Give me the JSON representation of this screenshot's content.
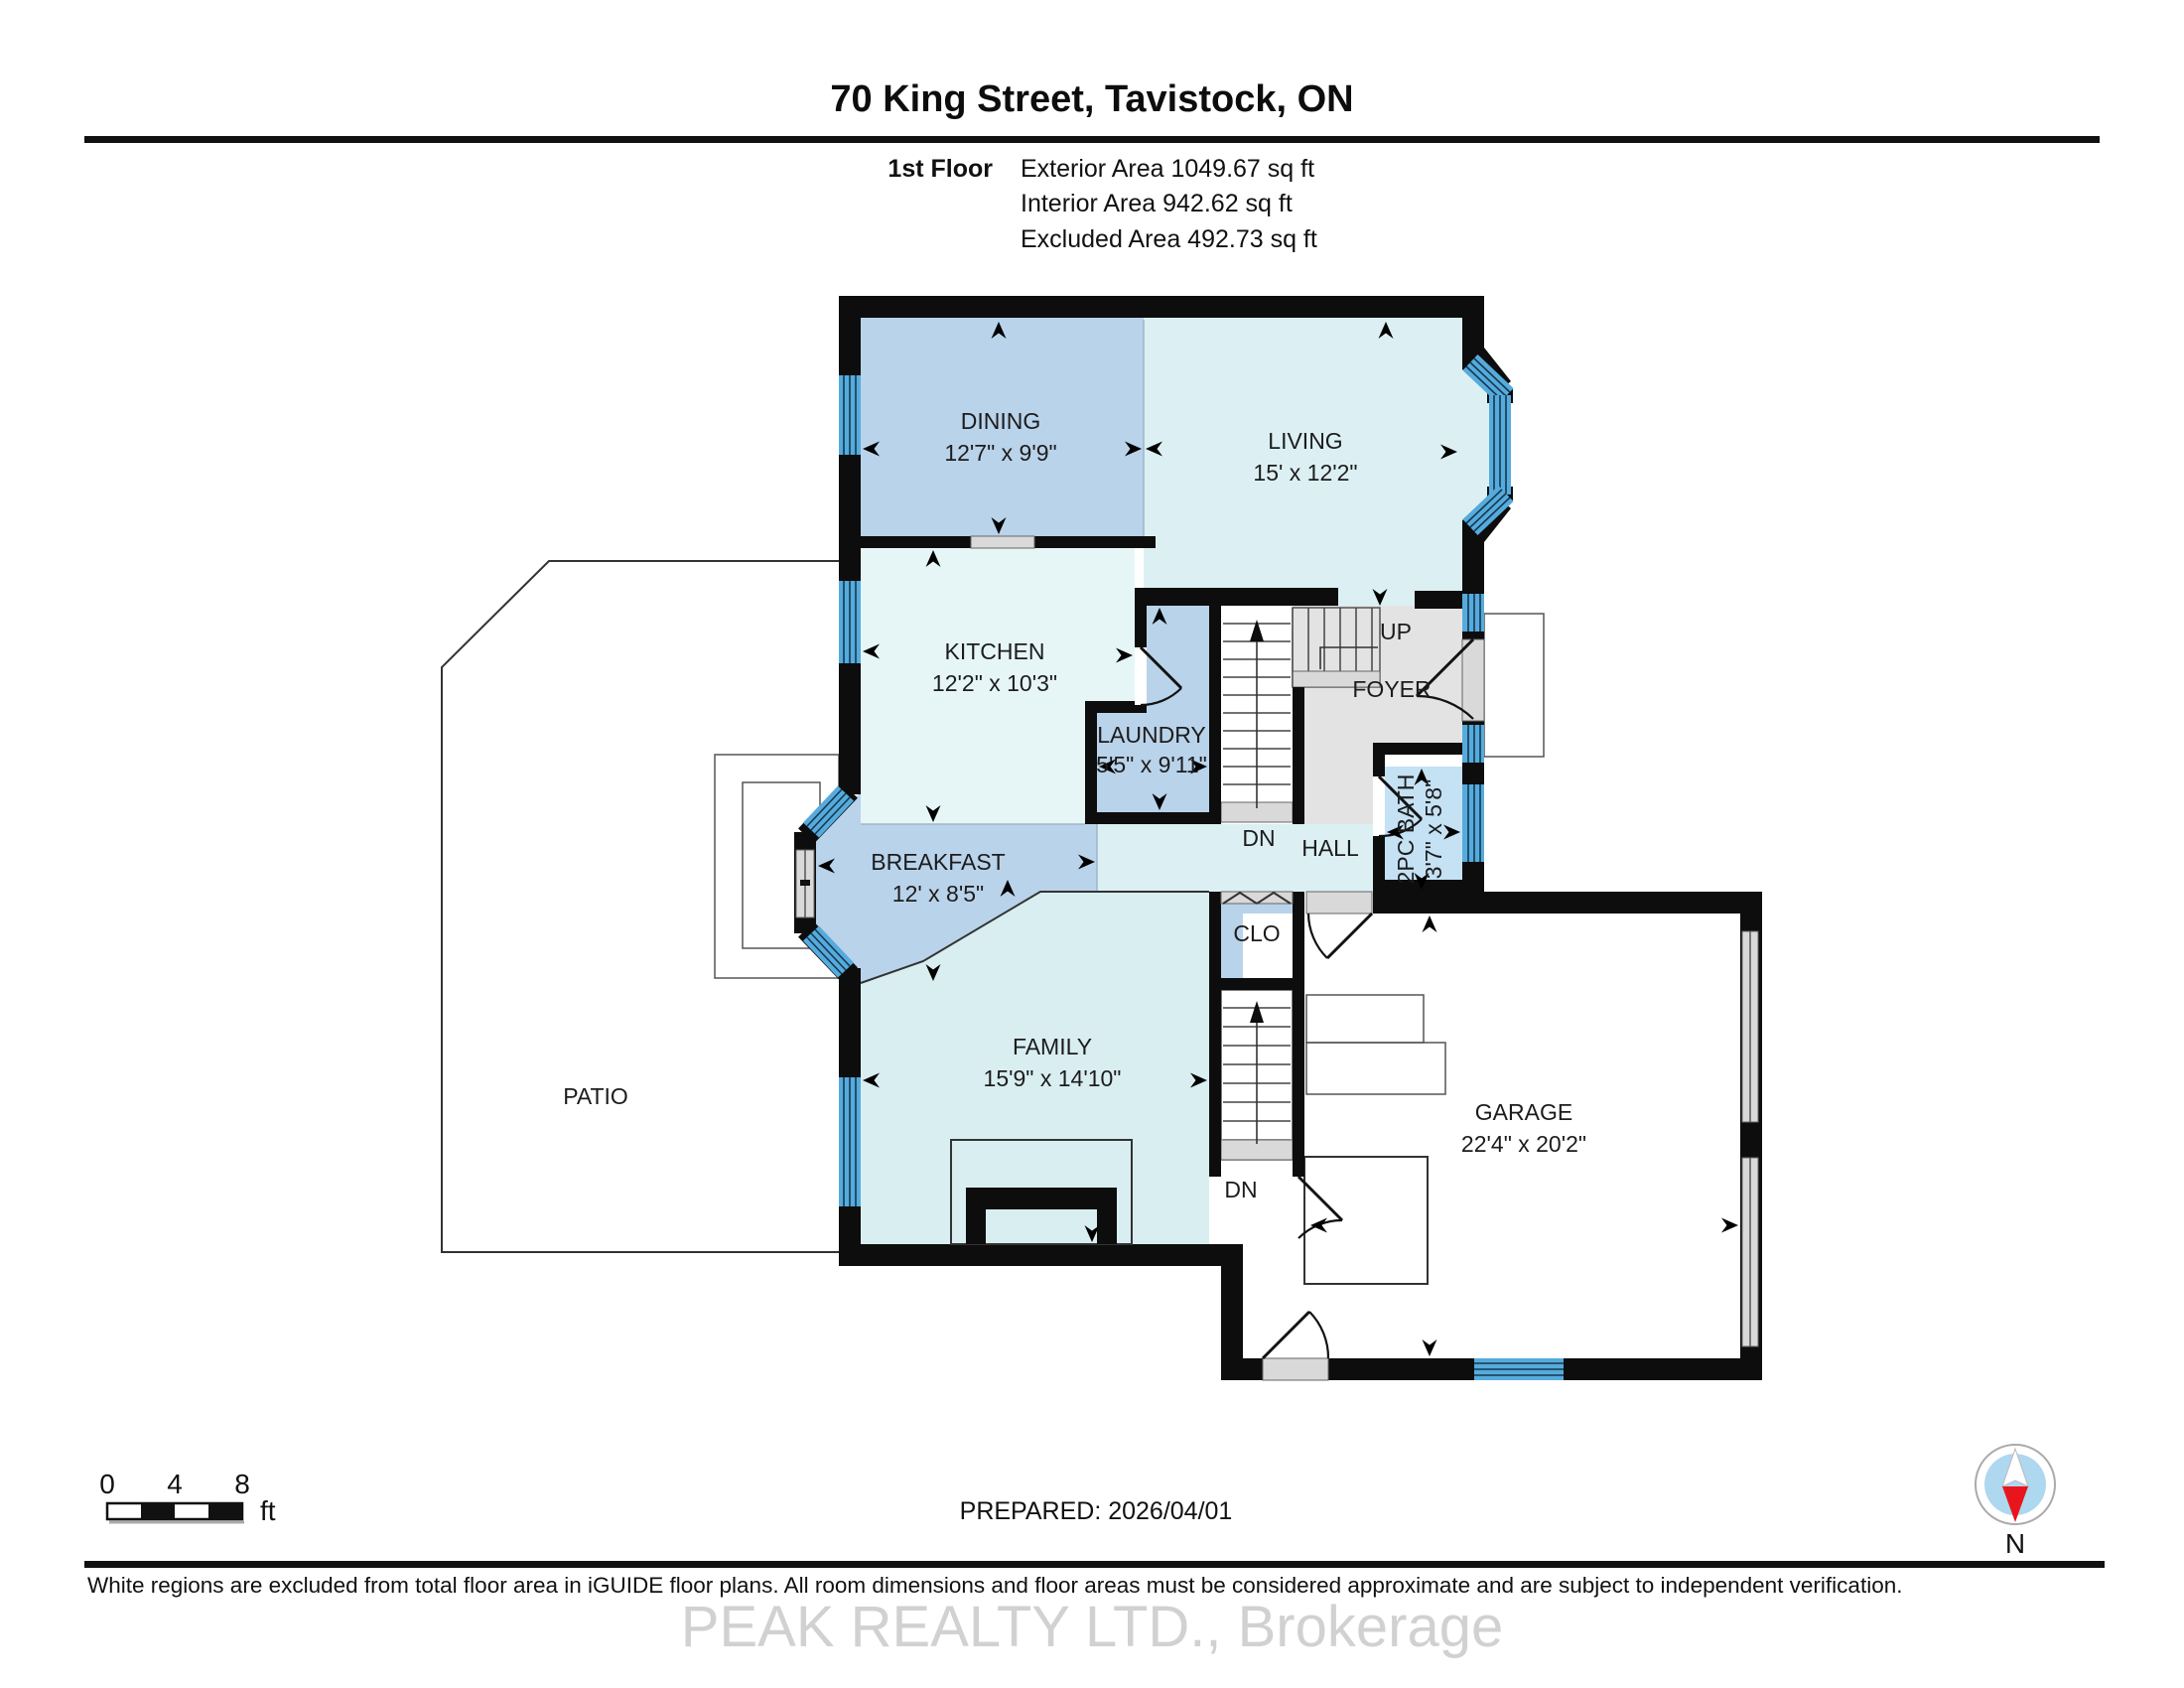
{
  "page_title": "70 King Street, Tavistock, ON",
  "header": {
    "floor_label": "1st Floor",
    "exterior_area": "Exterior Area 1049.67 sq ft",
    "interior_area": "Interior Area 942.62 sq ft",
    "excluded_area": "Excluded Area 492.73 sq ft"
  },
  "rooms": {
    "dining": {
      "name": "DINING",
      "dims": "12'7\" x 9'9\""
    },
    "living": {
      "name": "LIVING",
      "dims": "15' x 12'2\""
    },
    "kitchen": {
      "name": "KITCHEN",
      "dims": "12'2\" x 10'3\""
    },
    "laundry": {
      "name": "LAUNDRY",
      "dims": "5'5\" x 9'11\""
    },
    "breakfast": {
      "name": "BREAKFAST",
      "dims": "12' x 8'5\""
    },
    "family": {
      "name": "FAMILY",
      "dims": "15'9\" x 14'10\""
    },
    "garage": {
      "name": "GARAGE",
      "dims": "22'4\" x 20'2\""
    },
    "bath": {
      "name": "2PC BATH",
      "dims": "3'7\" x 5'8\""
    },
    "foyer": {
      "name": "FOYER"
    },
    "hall": {
      "name": "HALL"
    },
    "patio": {
      "name": "PATIO"
    },
    "closet": {
      "name": "CLO"
    }
  },
  "stairs": {
    "up": "UP",
    "down_upper": "DN",
    "down_lower": "DN"
  },
  "scale_bar": {
    "tick0": "0",
    "tick4": "4",
    "tick8": "8",
    "unit": "ft"
  },
  "prepared": "PREPARED: 2026/04/01",
  "compass": {
    "north": "N"
  },
  "disclaimer": "White regions are excluded from total floor area in iGUIDE floor plans. All room dimensions and floor areas must be considered approximate and are subject to independent verification.",
  "watermark": "PEAK REALTY LTD., Brokerage",
  "colors": {
    "room_blue": "#b9d3ea",
    "room_cyan": "#dcf0f3",
    "kitchen_cyan": "#e6f6f7",
    "family_cyan": "#d9eef1",
    "bath_blue": "#c5e1f4",
    "foyer_gray": "#e3e3e3",
    "window_blue": "#55abdd",
    "wall_black": "#0d0d0d",
    "sill_gray": "#d9d9d9",
    "compass_blue": "#aed7f0",
    "compass_red": "#e8151c",
    "watermark_gray": "#c6c6c6"
  }
}
